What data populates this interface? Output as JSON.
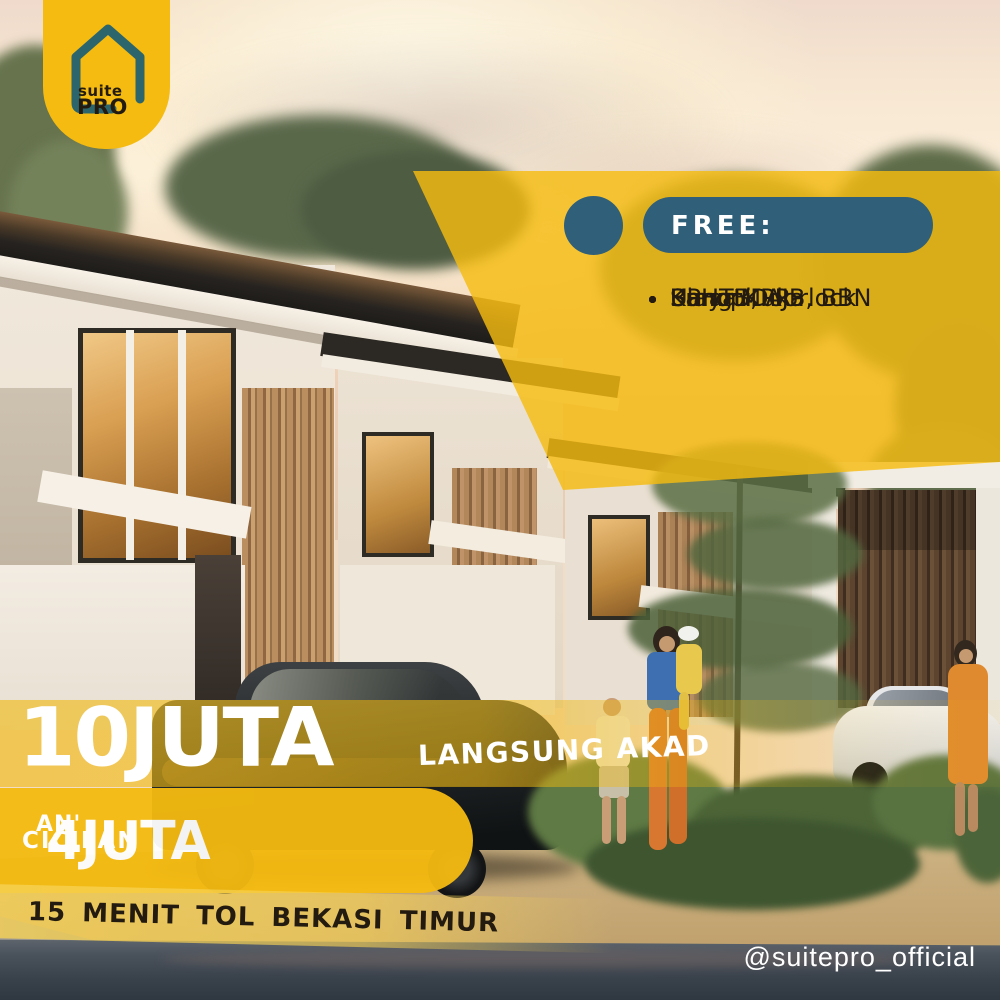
{
  "logo": {
    "line1": "suite",
    "line2": "PRO",
    "icon": "house-outline-icon"
  },
  "free_panel": {
    "title": "FREE:",
    "items": [
      "BPHTB, AJB, BBN",
      "Uang Muka",
      "Biaya KPR",
      "Smart Doorlock",
      "Kanopi"
    ]
  },
  "offer": {
    "dp_amount": "10JUTA",
    "dp_note": "LANGSUNG AKAD",
    "installment_label": "CICILAN",
    "installment_amount": "4JUTA",
    "installment_suffix": "AN'",
    "location_note": "15 MENIT TOL BEKASI TIMUR"
  },
  "footer": {
    "social_handle": "@suitepro_official"
  },
  "colors": {
    "brand_yellow": "#F5BB10",
    "teal": "#305F79",
    "icon_teal": "#2C666C",
    "dark_text": "#241B10",
    "white": "#FFFFFF"
  }
}
